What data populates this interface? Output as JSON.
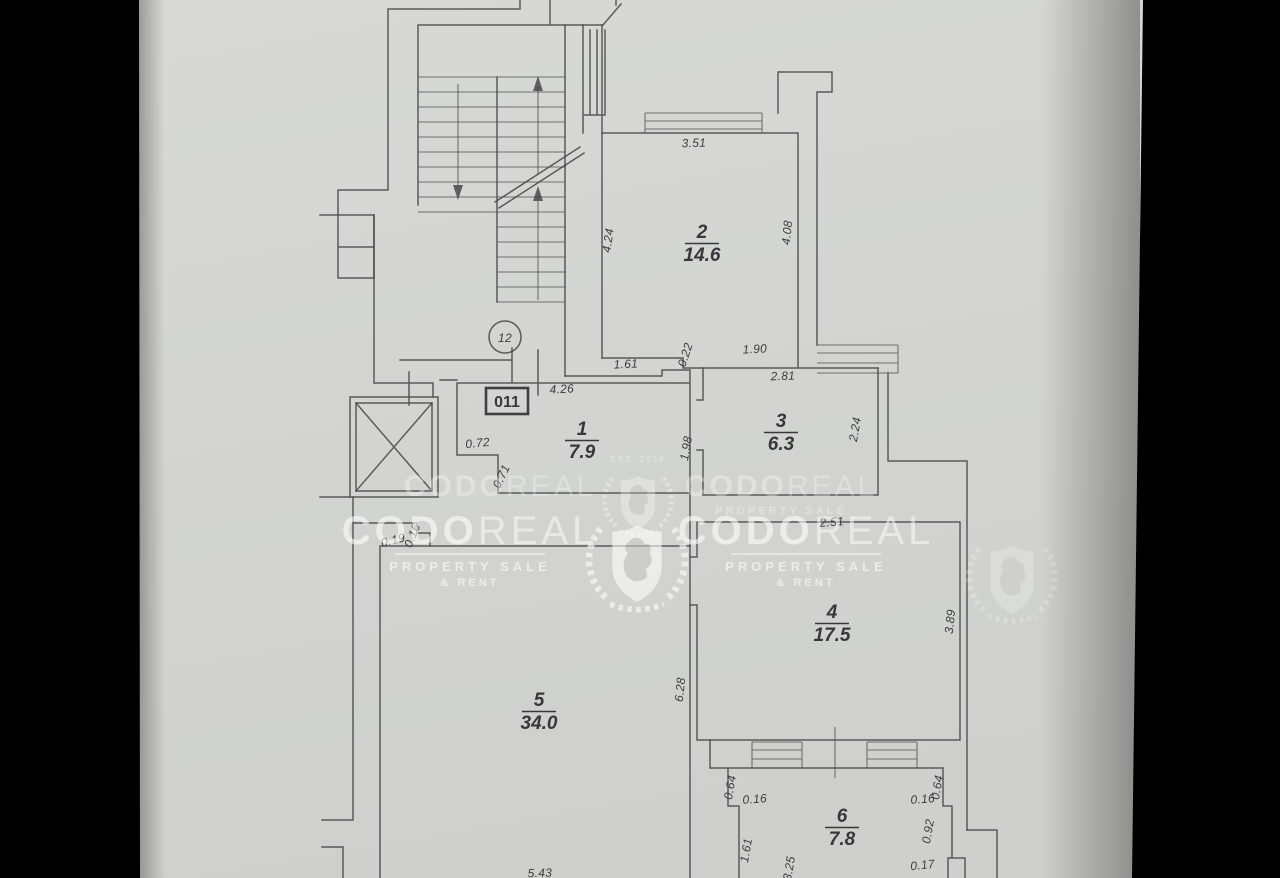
{
  "image": {
    "type": "scanned floor plan photo",
    "background_color": "#000000",
    "paper_color": "#d4d5d2",
    "line_color": "#4a494b"
  },
  "watermark": {
    "brand_bold": "CODO",
    "brand_light": "REAL",
    "tagline": "PROPERTY SALE",
    "tagline2": "& RENT",
    "established": "EST. 2014"
  },
  "plan": {
    "floor_circle_label": "12",
    "unit_box_label": "011",
    "rooms": [
      {
        "number": "1",
        "area": "7.9",
        "x": 582,
        "y": 435
      },
      {
        "number": "2",
        "area": "14.6",
        "x": 702,
        "y": 238
      },
      {
        "number": "3",
        "area": "6.3",
        "x": 781,
        "y": 427
      },
      {
        "number": "4",
        "area": "17.5",
        "x": 832,
        "y": 618
      },
      {
        "number": "5",
        "area": "34.0",
        "x": 539,
        "y": 706
      },
      {
        "number": "6",
        "area": "7.8",
        "x": 842,
        "y": 822
      }
    ],
    "dimensions": [
      {
        "t": "3.51",
        "x": 694,
        "y": 147,
        "r": -2
      },
      {
        "t": "4.24",
        "x": 612,
        "y": 241,
        "r": -82
      },
      {
        "t": "4.08",
        "x": 791,
        "y": 233,
        "r": -84
      },
      {
        "t": "1.61",
        "x": 626,
        "y": 368,
        "r": -3
      },
      {
        "t": "0.22",
        "x": 689,
        "y": 356,
        "r": -72
      },
      {
        "t": "1.90",
        "x": 755,
        "y": 353,
        "r": -3
      },
      {
        "t": "2.81",
        "x": 783,
        "y": 380,
        "r": -2
      },
      {
        "t": "2.24",
        "x": 859,
        "y": 430,
        "r": -80
      },
      {
        "t": "1.98",
        "x": 690,
        "y": 449,
        "r": -80
      },
      {
        "t": "4.26",
        "x": 562,
        "y": 393,
        "r": -3
      },
      {
        "t": "0.72",
        "x": 478,
        "y": 447,
        "r": -6
      },
      {
        "t": "0.71",
        "x": 505,
        "y": 478,
        "r": -65
      },
      {
        "t": "2.51",
        "x": 832,
        "y": 526,
        "r": -4
      },
      {
        "t": "3.89",
        "x": 954,
        "y": 622,
        "r": -84
      },
      {
        "t": "6.28",
        "x": 684,
        "y": 690,
        "r": -84
      },
      {
        "t": "0.19",
        "x": 394,
        "y": 544,
        "r": -14
      },
      {
        "t": "0.16",
        "x": 416,
        "y": 537,
        "r": -68
      },
      {
        "t": "0.64",
        "x": 734,
        "y": 788,
        "r": -80
      },
      {
        "t": "0.16",
        "x": 755,
        "y": 803,
        "r": -4
      },
      {
        "t": "1.61",
        "x": 750,
        "y": 851,
        "r": -80
      },
      {
        "t": "3.25",
        "x": 793,
        "y": 869,
        "r": -80
      },
      {
        "t": "0.64",
        "x": 941,
        "y": 788,
        "r": -80
      },
      {
        "t": "0.16",
        "x": 923,
        "y": 803,
        "r": -4
      },
      {
        "t": "0.92",
        "x": 932,
        "y": 832,
        "r": -80
      },
      {
        "t": "0.17",
        "x": 923,
        "y": 869,
        "r": -6
      },
      {
        "t": "5.43",
        "x": 540,
        "y": 877,
        "r": -2
      }
    ]
  }
}
